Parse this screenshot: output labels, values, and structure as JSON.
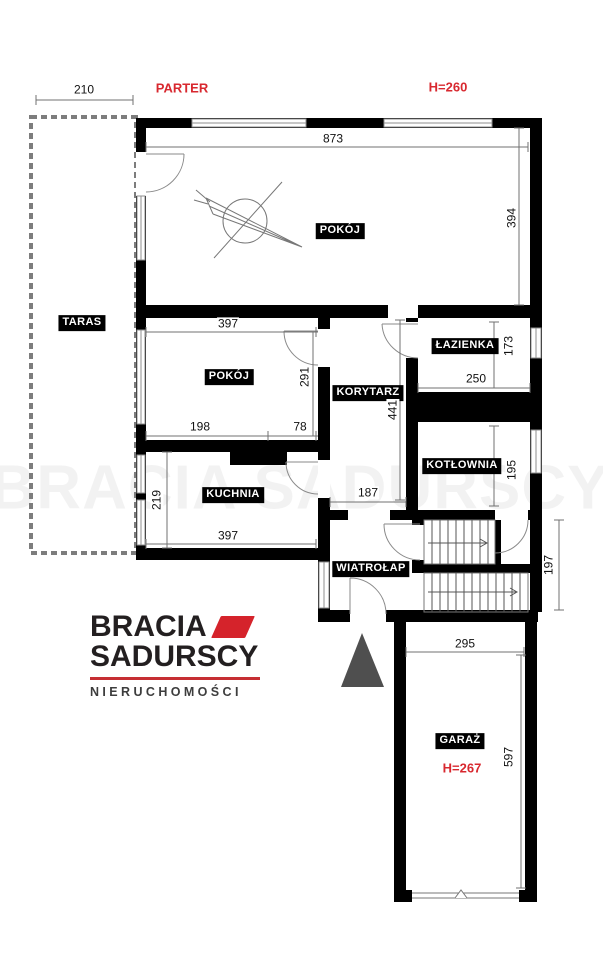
{
  "plan": {
    "floor_label": "PARTER",
    "ceiling_height_label": "H=260",
    "garage_height_label": "H=267",
    "rooms": {
      "pokoj_main": "POKÓJ",
      "taras": "TARAS",
      "pokoj_small": "POKÓJ",
      "korytarz": "KORYTARZ",
      "lazienka": "ŁAZIENKA",
      "kotlownia": "KOTŁOWNIA",
      "kuchnia": "KUCHNIA",
      "wiatrolap": "WIATROŁAP",
      "garaz": "GARAŻ"
    },
    "dimensions": {
      "taras_width": "210",
      "pokoj_main_width": "873",
      "pokoj_main_depth": "394",
      "pokoj_small_width": "397",
      "pokoj_small_depth": "291",
      "pokoj_small_seg1": "198",
      "pokoj_small_seg2": "78",
      "lazienka_depth": "173",
      "lazienka_width": "250",
      "korytarz_length": "441",
      "kotlownia_depth": "195",
      "korytarz_width": "187",
      "kuchnia_depth": "219",
      "kuchnia_width": "397",
      "stairs_depth": "197",
      "garaz_width": "295",
      "garaz_depth": "597"
    }
  },
  "logo": {
    "line1": "BRACIA",
    "line2": "SADURSCY",
    "line3": "NIERUCHOMOŚCI"
  },
  "watermark": "BRACIA SADURSCY",
  "colors": {
    "wall": "#000000",
    "accent_red": "#d8282f",
    "logo_dark": "#231f20",
    "logo_red": "#d5232b",
    "north_arrow_gray": "#4f4f4f",
    "window_outline": "#8f8f8f",
    "dimension_line": "#707070"
  }
}
